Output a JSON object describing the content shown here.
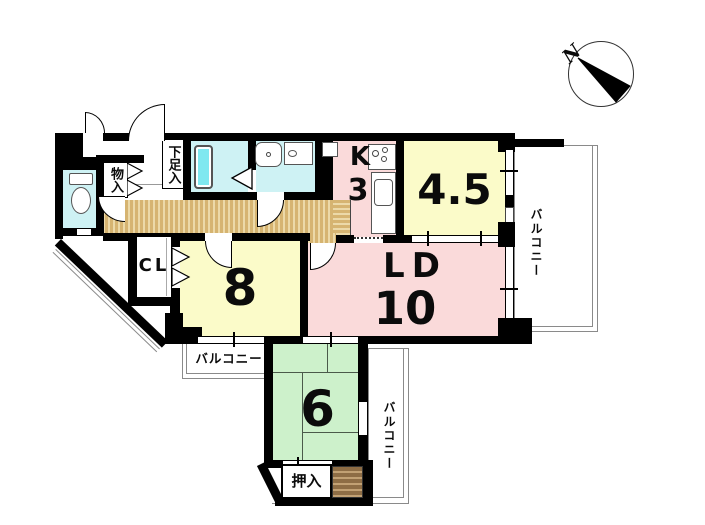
{
  "floorplan": {
    "compass": {
      "north_label": "N"
    },
    "rooms": {
      "western_room_45": {
        "label": "4.5"
      },
      "kitchen": {
        "type_label": "K",
        "size_label": "3"
      },
      "living_dining": {
        "type_label": "LD",
        "size_label": "10"
      },
      "western_room_8": {
        "label": "8"
      },
      "japanese_room_6": {
        "label": "6"
      },
      "closet": {
        "label": "CL"
      },
      "shoe_closet": {
        "label": "下足入"
      },
      "storage": {
        "label": "物入"
      },
      "futon_closet": {
        "label": "押入"
      }
    },
    "balconies": {
      "east": {
        "label": "バルコニー"
      },
      "south_west": {
        "label": "バルコニー"
      },
      "south": {
        "label": "バルコニー"
      }
    },
    "palette": {
      "wall_black": "#000000",
      "room_yellow": "#FBFBC9",
      "room_pink": "#FADADA",
      "tatami_green": "#CDF1CB",
      "wet_area_cyan": "#CEF2F4",
      "bathtub_cyan": "#7FE8F0",
      "hallway_tan": "#D6B471",
      "step_brown": "#8E6D45"
    }
  }
}
